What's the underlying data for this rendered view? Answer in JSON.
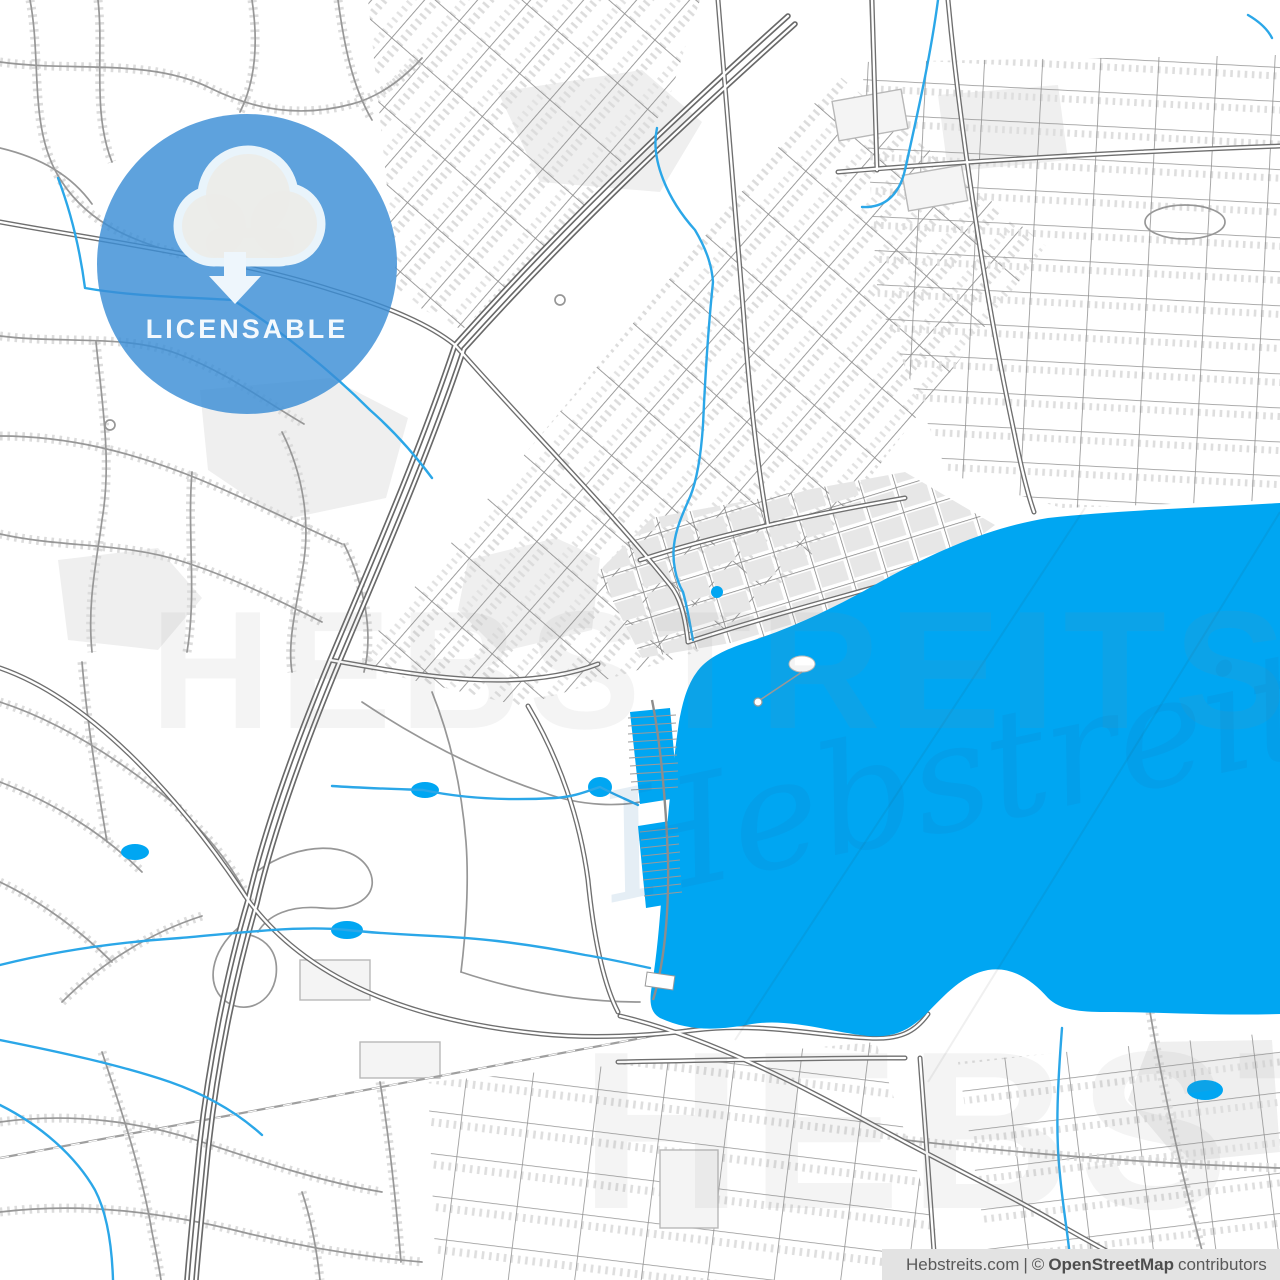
{
  "badge": {
    "label": "LICENSABLE",
    "icon": "cloud-download"
  },
  "watermarks": {
    "caps_center": "HEBSTREITS",
    "caps_bottom": "HEBSTREITS",
    "signature": "Hebstreits"
  },
  "attribution": {
    "source": "Hebstreits.com",
    "divider": "|",
    "copyright_symbol": "©",
    "provider": "OpenStreetMap",
    "suffix": "contributors"
  },
  "colors": {
    "land": "#ffffff",
    "water": "#00a6f2",
    "stream": "#2ba7e8",
    "park": "#efefef",
    "road_major_casing": "#6f6f6f",
    "road_minor": "#979797",
    "building_texture": "#dcdcdc",
    "downtown_block": "#e7e7e7",
    "badge_blue": "#3b8ed6",
    "badge_text": "#f4f9fd",
    "cloud_outline": "#e9f4fb",
    "cloud_fill": "#ecece9",
    "arrow": "#eef6fc",
    "attribution_bg": "#e3e3e3",
    "attribution_text": "#595959"
  }
}
